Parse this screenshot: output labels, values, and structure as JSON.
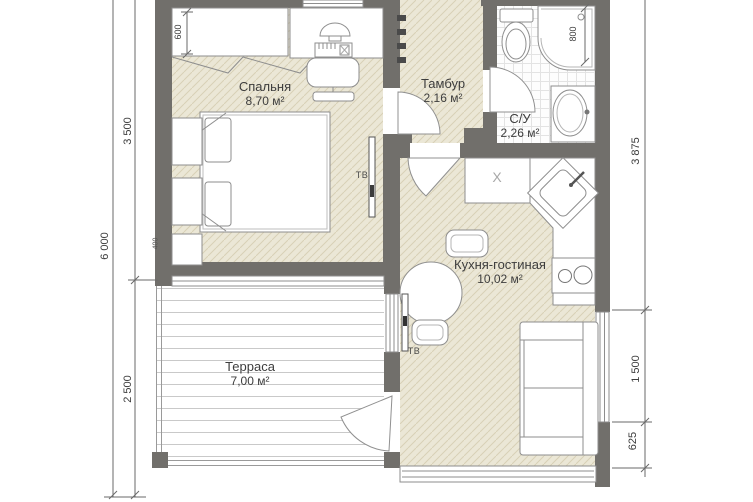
{
  "document": {
    "kind": "floor-plan"
  },
  "rooms": {
    "bedroom": {
      "name": "Спальня",
      "area": "8,70 м²"
    },
    "vestibule": {
      "name": "Тамбур",
      "area": "2,16 м²"
    },
    "bathroom": {
      "name": "С/У",
      "area": "2,26 м²"
    },
    "kitchen_living": {
      "name": "Кухня-гостиная",
      "area": "10,02 м²"
    },
    "terrace": {
      "name": "Терраса",
      "area": "7,00 м²"
    }
  },
  "dimensions": {
    "left_total": "6 000",
    "left_upper": "3 500",
    "left_lower": "2 500",
    "right_upper": "3 875",
    "right_middle": "1 500",
    "right_lower": "625",
    "wardrobe_depth": "600",
    "shower_width": "800",
    "bedside_width": "400"
  },
  "annotations": {
    "tv_bedroom": "ТВ",
    "tv_kitchen": "ТВ",
    "cabinet_mark": "X"
  },
  "colors": {
    "wall": "#716f6b",
    "floor_fill": "#ebe7d6",
    "floor_hatch": "#d8d1b6",
    "outline": "#8e8e8e",
    "text": "#3d3d3d"
  }
}
